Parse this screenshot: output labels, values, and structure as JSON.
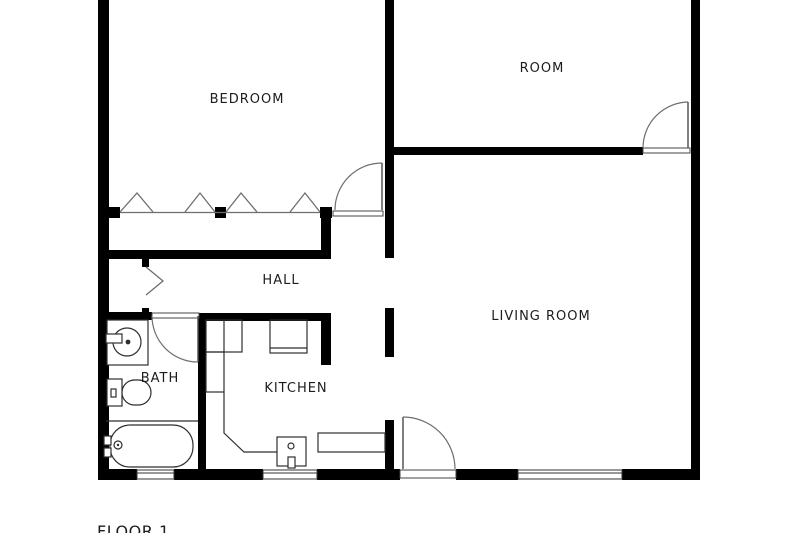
{
  "plan": {
    "rooms": [
      {
        "id": "bedroom",
        "label": "BEDROOM"
      },
      {
        "id": "room",
        "label": "ROOM"
      },
      {
        "id": "hall",
        "label": "HALL"
      },
      {
        "id": "bath",
        "label": "BATH"
      },
      {
        "id": "kitchen",
        "label": "KITCHEN"
      },
      {
        "id": "living-room",
        "label": "LIVING ROOM"
      }
    ],
    "floor_label": "FLOOR 1",
    "colors": {
      "wall": "#000000",
      "background": "#ffffff",
      "fixture_line": "#2e2e2e",
      "door_arc": "#6e6e6e"
    },
    "fixtures": [
      "washing-machine",
      "toilet",
      "bathtub",
      "kitchen-counter",
      "stove",
      "kitchen-sink",
      "dishwasher-counter",
      "closet-folding-doors",
      "hall-folding-door",
      "bedroom-door",
      "room-door",
      "bath-door",
      "entry-door",
      "bath-window",
      "kitchen-window",
      "living-room-window"
    ]
  }
}
